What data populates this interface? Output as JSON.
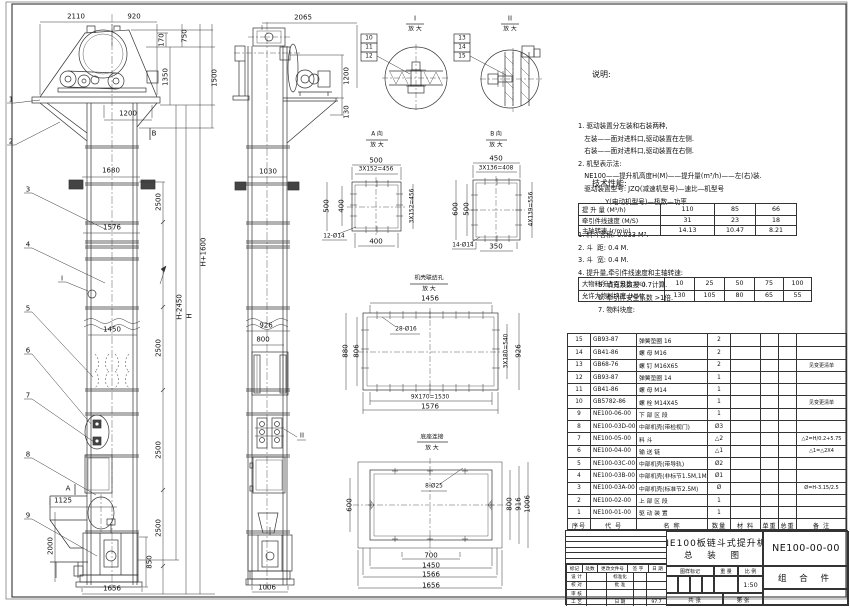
{
  "notes": {
    "title": "说明:",
    "lines": [
      "1. 驱动装置分左装和右装两种,",
      "   左装——面对进料口,驱动装置在左侧.",
      "   右装——面对进料口,驱动装置在右侧.",
      "2. 机型表示法:",
      "   NE100——提升机高度H(M)——提升量(m³/h)——左(右)装.",
      "   驱动装置型号: JZQ(减速机型号)—速比—机型号",
      "             Y(电动机型号)—极数—功率"
    ]
  },
  "tech": {
    "title": "技术性能:",
    "items1": [
      "1. 料斗容积: 0.033 M³.",
      "2. 斗  距: 0.4 M.",
      "3. 斗  宽: 0.4 M.",
      "4. 提升量,牵引件线速度和主轴转速:"
    ],
    "table1": {
      "rows": [
        [
          "提 升 量  (M³/h)",
          "110",
          "85",
          "66"
        ],
        [
          "牵引件线速度 (M/S)",
          "31",
          "23",
          "18"
        ],
        [
          "主轴转速  (r/min)",
          "14.13",
          "10.47",
          "8.21"
        ]
      ]
    },
    "items2": [
      "5. 填充系数按 0.7计算.",
      "6. 牵引件安全系数 >1倍.",
      "7. 物料块度:"
    ],
    "table2": {
      "rows": [
        [
          "大物料所占百分比 (%)",
          "10",
          "25",
          "50",
          "75",
          "100"
        ],
        [
          "允许大物料块度 (MM)",
          "130",
          "105",
          "80",
          "65",
          "55"
        ]
      ]
    }
  },
  "bom": {
    "headers": [
      "序号",
      "代  号",
      "名  称",
      "数量",
      "材  料",
      "单重",
      "总重",
      "备  注"
    ],
    "rows": [
      [
        "15",
        "GB93-87",
        "弹簧垫圈  16",
        "2",
        "",
        "",
        "",
        ""
      ],
      [
        "14",
        "GB41-86",
        "螺  母  M16",
        "2",
        "",
        "",
        "",
        ""
      ],
      [
        "13",
        "GB68-76",
        "螺  钉  M16X65",
        "2",
        "",
        "",
        "",
        "见变更清单"
      ],
      [
        "12",
        "GB93-87",
        "弹簧垫圈  14",
        "1",
        "",
        "",
        "",
        ""
      ],
      [
        "11",
        "GB41-86",
        "螺  母  M14",
        "1",
        "",
        "",
        "",
        ""
      ],
      [
        "10",
        "GB5782-86",
        "螺  栓  M14X45",
        "1",
        "",
        "",
        "",
        "见变更清单"
      ],
      [
        "9",
        "NE100-06-00",
        "下 部 区 段",
        "1",
        "",
        "",
        "",
        ""
      ],
      [
        "8",
        "NE100-03D-00",
        "中部机壳(带检视门)",
        "Ø3",
        "",
        "",
        "",
        ""
      ],
      [
        "7",
        "NE100-05-00",
        "料  斗",
        "△2",
        "",
        "",
        "",
        "△2=H/0.2+5.75"
      ],
      [
        "6",
        "NE100-04-00",
        "输 送 链",
        "△1",
        "",
        "",
        "",
        "△1=△2X4"
      ],
      [
        "5",
        "NE100-03C-00",
        "中部机壳(带导轨)",
        "Ø2",
        "",
        "",
        "",
        ""
      ],
      [
        "4",
        "NE100-03B-00",
        "中部机壳(非标节1.5M,1M)",
        "Ø1",
        "",
        "",
        "",
        ""
      ],
      [
        "3",
        "NE100-03A-00",
        "中部机壳(标准节2.5M)",
        "Ø",
        "",
        "",
        "",
        "Ø=H-3.15/2.5"
      ],
      [
        "2",
        "NE100-02-00",
        "上 部 区 段",
        "1",
        "",
        "",
        "",
        ""
      ],
      [
        "1",
        "NE100-01-00",
        "驱 动 装 置",
        "1",
        "",
        "",
        "",
        ""
      ]
    ]
  },
  "title_block": {
    "product": "NE100板链斗式提升机",
    "drawing_type": "总  装  图",
    "drawing_no": "NE100-00-00",
    "part_class": "组 合 件",
    "mark_label": "图样标记",
    "weight_label": "重 量",
    "scale_label": "比 例",
    "scale_value": "1:50",
    "sheets_total": "共    张",
    "sheet_no": "第    张",
    "date_value": "97.7",
    "rev_header": [
      "标记",
      "处数",
      "更改文件号",
      "签 字",
      "日 期"
    ],
    "sign_rows": [
      [
        "设 计",
        "",
        "标准化",
        "",
        ""
      ],
      [
        "校 对",
        "",
        "批 准",
        "",
        ""
      ],
      [
        "审 核",
        "",
        "",
        "",
        ""
      ],
      [
        "工 艺",
        "",
        "日 期",
        "",
        "97.7"
      ]
    ]
  },
  "annotations": [
    {
      "t": "2110",
      "x": 76,
      "y": 17
    },
    {
      "t": "920",
      "x": 134,
      "y": 17
    },
    {
      "t": "170",
      "x": 162,
      "y": 40,
      "r": 1
    },
    {
      "t": "750",
      "x": 185,
      "y": 36,
      "r": 1
    },
    {
      "t": "1350",
      "x": 166,
      "y": 77,
      "r": 1
    },
    {
      "t": "1500",
      "x": 215,
      "y": 78,
      "r": 1
    },
    {
      "t": "1200",
      "x": 128,
      "y": 114
    },
    {
      "t": "B",
      "x": 154,
      "y": 134
    },
    {
      "t": "1680",
      "x": 111,
      "y": 171
    },
    {
      "t": "2500",
      "x": 159,
      "y": 202,
      "r": 1
    },
    {
      "t": "1576",
      "x": 112,
      "y": 228
    },
    {
      "t": "H+1600",
      "x": 204,
      "y": 252,
      "r": 1
    },
    {
      "t": "H-2450",
      "x": 180,
      "y": 307,
      "r": 1
    },
    {
      "t": "H",
      "x": 190,
      "y": 316,
      "r": 1
    },
    {
      "t": "1450",
      "x": 112,
      "y": 330
    },
    {
      "t": "2500",
      "x": 159,
      "y": 348,
      "r": 1
    },
    {
      "t": "2500",
      "x": 159,
      "y": 450,
      "r": 1
    },
    {
      "t": "2500",
      "x": 159,
      "y": 528,
      "r": 1
    },
    {
      "t": "1125",
      "x": 63,
      "y": 501
    },
    {
      "t": "A",
      "x": 68,
      "y": 489
    },
    {
      "t": "2000",
      "x": 51,
      "y": 546,
      "r": 1
    },
    {
      "t": "850",
      "x": 150,
      "y": 562,
      "r": 1
    },
    {
      "t": "1656",
      "x": 112,
      "y": 589
    },
    {
      "t": "I",
      "x": 62,
      "y": 279
    },
    {
      "t": "1",
      "x": 11,
      "y": 100
    },
    {
      "t": "2",
      "x": 11,
      "y": 142
    },
    {
      "t": "3",
      "x": 28,
      "y": 190
    },
    {
      "t": "4",
      "x": 28,
      "y": 245
    },
    {
      "t": "5",
      "x": 28,
      "y": 309
    },
    {
      "t": "6",
      "x": 28,
      "y": 351
    },
    {
      "t": "7",
      "x": 28,
      "y": 396
    },
    {
      "t": "8",
      "x": 28,
      "y": 455
    },
    {
      "t": "9",
      "x": 28,
      "y": 516
    },
    {
      "t": "2065",
      "x": 303,
      "y": 18
    },
    {
      "t": "1200",
      "x": 347,
      "y": 76,
      "r": 1
    },
    {
      "t": "130",
      "x": 347,
      "y": 112,
      "r": 1
    },
    {
      "t": "1030",
      "x": 268,
      "y": 172
    },
    {
      "t": "926",
      "x": 266,
      "y": 326
    },
    {
      "t": "800",
      "x": 263,
      "y": 340
    },
    {
      "t": "II",
      "x": 302,
      "y": 436
    },
    {
      "t": "1006",
      "x": 267,
      "y": 588
    },
    {
      "t": "I",
      "x": 415,
      "y": 19
    },
    {
      "t": "放 大",
      "x": 415,
      "y": 30,
      "s": 1
    },
    {
      "t": "10",
      "x": 369,
      "y": 39,
      "s": 1
    },
    {
      "t": "11",
      "x": 369,
      "y": 48,
      "s": 1
    },
    {
      "t": "12",
      "x": 369,
      "y": 57,
      "s": 1
    },
    {
      "t": "II",
      "x": 510,
      "y": 19
    },
    {
      "t": "放 大",
      "x": 510,
      "y": 30,
      "s": 1
    },
    {
      "t": "13",
      "x": 462,
      "y": 39,
      "s": 1
    },
    {
      "t": "14",
      "x": 462,
      "y": 48,
      "s": 1
    },
    {
      "t": "15",
      "x": 462,
      "y": 57,
      "s": 1
    },
    {
      "t": "A 向",
      "x": 377,
      "y": 135,
      "s": 1
    },
    {
      "t": "放 大",
      "x": 377,
      "y": 146,
      "s": 1
    },
    {
      "t": "500",
      "x": 376,
      "y": 161
    },
    {
      "t": "3X152=456",
      "x": 376,
      "y": 170,
      "s": 1
    },
    {
      "t": "500",
      "x": 327,
      "y": 206,
      "r": 1
    },
    {
      "t": "400",
      "x": 342,
      "y": 206,
      "r": 1
    },
    {
      "t": "3X152=456",
      "x": 413,
      "y": 206,
      "r": 1,
      "s": 1
    },
    {
      "t": "400",
      "x": 376,
      "y": 242
    },
    {
      "t": "12-Ø14",
      "x": 334,
      "y": 237,
      "s": 1
    },
    {
      "t": "B 向",
      "x": 496,
      "y": 135,
      "s": 1
    },
    {
      "t": "放 大",
      "x": 496,
      "y": 146,
      "s": 1
    },
    {
      "t": "450",
      "x": 496,
      "y": 159
    },
    {
      "t": "3X136=408",
      "x": 496,
      "y": 169,
      "s": 1
    },
    {
      "t": "600",
      "x": 456,
      "y": 209,
      "r": 1
    },
    {
      "t": "500",
      "x": 467,
      "y": 209,
      "r": 1
    },
    {
      "t": "4X139=556",
      "x": 532,
      "y": 209,
      "r": 1,
      "s": 1
    },
    {
      "t": "350",
      "x": 496,
      "y": 247
    },
    {
      "t": "14-Ø14",
      "x": 463,
      "y": 246,
      "s": 1
    },
    {
      "t": "机壳联结孔",
      "x": 429,
      "y": 279,
      "s": 1
    },
    {
      "t": "放 大",
      "x": 429,
      "y": 290,
      "s": 1
    },
    {
      "t": "1456",
      "x": 430,
      "y": 299
    },
    {
      "t": "28-Ø16",
      "x": 406,
      "y": 330,
      "s": 1
    },
    {
      "t": "880",
      "x": 346,
      "y": 351,
      "r": 1
    },
    {
      "t": "806",
      "x": 357,
      "y": 351,
      "r": 1
    },
    {
      "t": "3X180=540",
      "x": 507,
      "y": 351,
      "r": 1,
      "s": 1
    },
    {
      "t": "926",
      "x": 519,
      "y": 351,
      "r": 1
    },
    {
      "t": "9X170=1530",
      "x": 430,
      "y": 398,
      "s": 1
    },
    {
      "t": "1576",
      "x": 430,
      "y": 407
    },
    {
      "t": "底座连接",
      "x": 432,
      "y": 438,
      "s": 1
    },
    {
      "t": "放 大",
      "x": 432,
      "y": 449,
      "s": 1
    },
    {
      "t": "8-Ø25",
      "x": 434,
      "y": 487,
      "s": 1
    },
    {
      "t": "600",
      "x": 350,
      "y": 505,
      "r": 1
    },
    {
      "t": "800",
      "x": 510,
      "y": 504,
      "r": 1
    },
    {
      "t": "916",
      "x": 519,
      "y": 504,
      "r": 1
    },
    {
      "t": "1006",
      "x": 528,
      "y": 504,
      "r": 1
    },
    {
      "t": "700",
      "x": 431,
      "y": 556
    },
    {
      "t": "1450",
      "x": 431,
      "y": 566
    },
    {
      "t": "1566",
      "x": 431,
      "y": 575
    },
    {
      "t": "1656",
      "x": 431,
      "y": 586
    }
  ]
}
